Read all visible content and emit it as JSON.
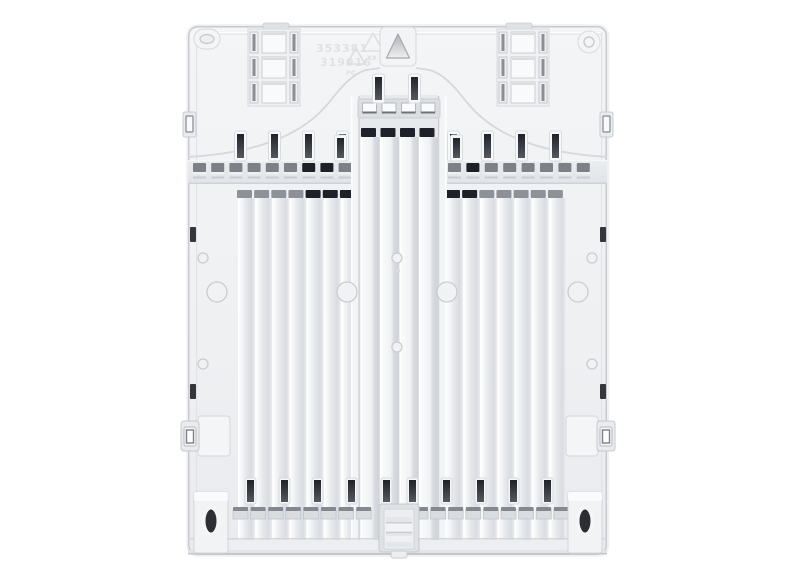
{
  "scene": {
    "background": "#ffffff"
  },
  "panel": {
    "markings": {
      "part_number_line1": "353381",
      "part_number_line2": "319916",
      "material_mark": "XX",
      "material_code": "PC"
    },
    "colors": {
      "body": "#eff1f3",
      "edge": "#c7cacf",
      "groove": "#e0e3e7",
      "rib_highlight": "#ffffff",
      "slot_dark": "#26282f",
      "cap_gray": "#8e9197",
      "cap_dark": "#1f212a",
      "rail_slot_gray": "#7d8086",
      "recess": "#e7e9ec",
      "hole_dark": "#2c2e34"
    },
    "features": {
      "left_ribs": {
        "count": 7,
        "dark_cap_indices": [
          4,
          5,
          6
        ]
      },
      "right_ribs": {
        "count": 7,
        "dark_cap_indices": [
          0,
          1
        ]
      },
      "center_ribs": {
        "count": 4
      },
      "rail_left": {
        "count": 9,
        "dark_indices": [
          6,
          7
        ]
      },
      "rail_right": {
        "count": 8,
        "dark_indices": [
          1
        ]
      },
      "top_vent_slots": {
        "count": 4
      },
      "bottom_tabs_left": {
        "count": 8
      },
      "bottom_tabs_right": {
        "count": 9
      },
      "grids": {
        "rows": 3,
        "cols": 3
      }
    }
  }
}
